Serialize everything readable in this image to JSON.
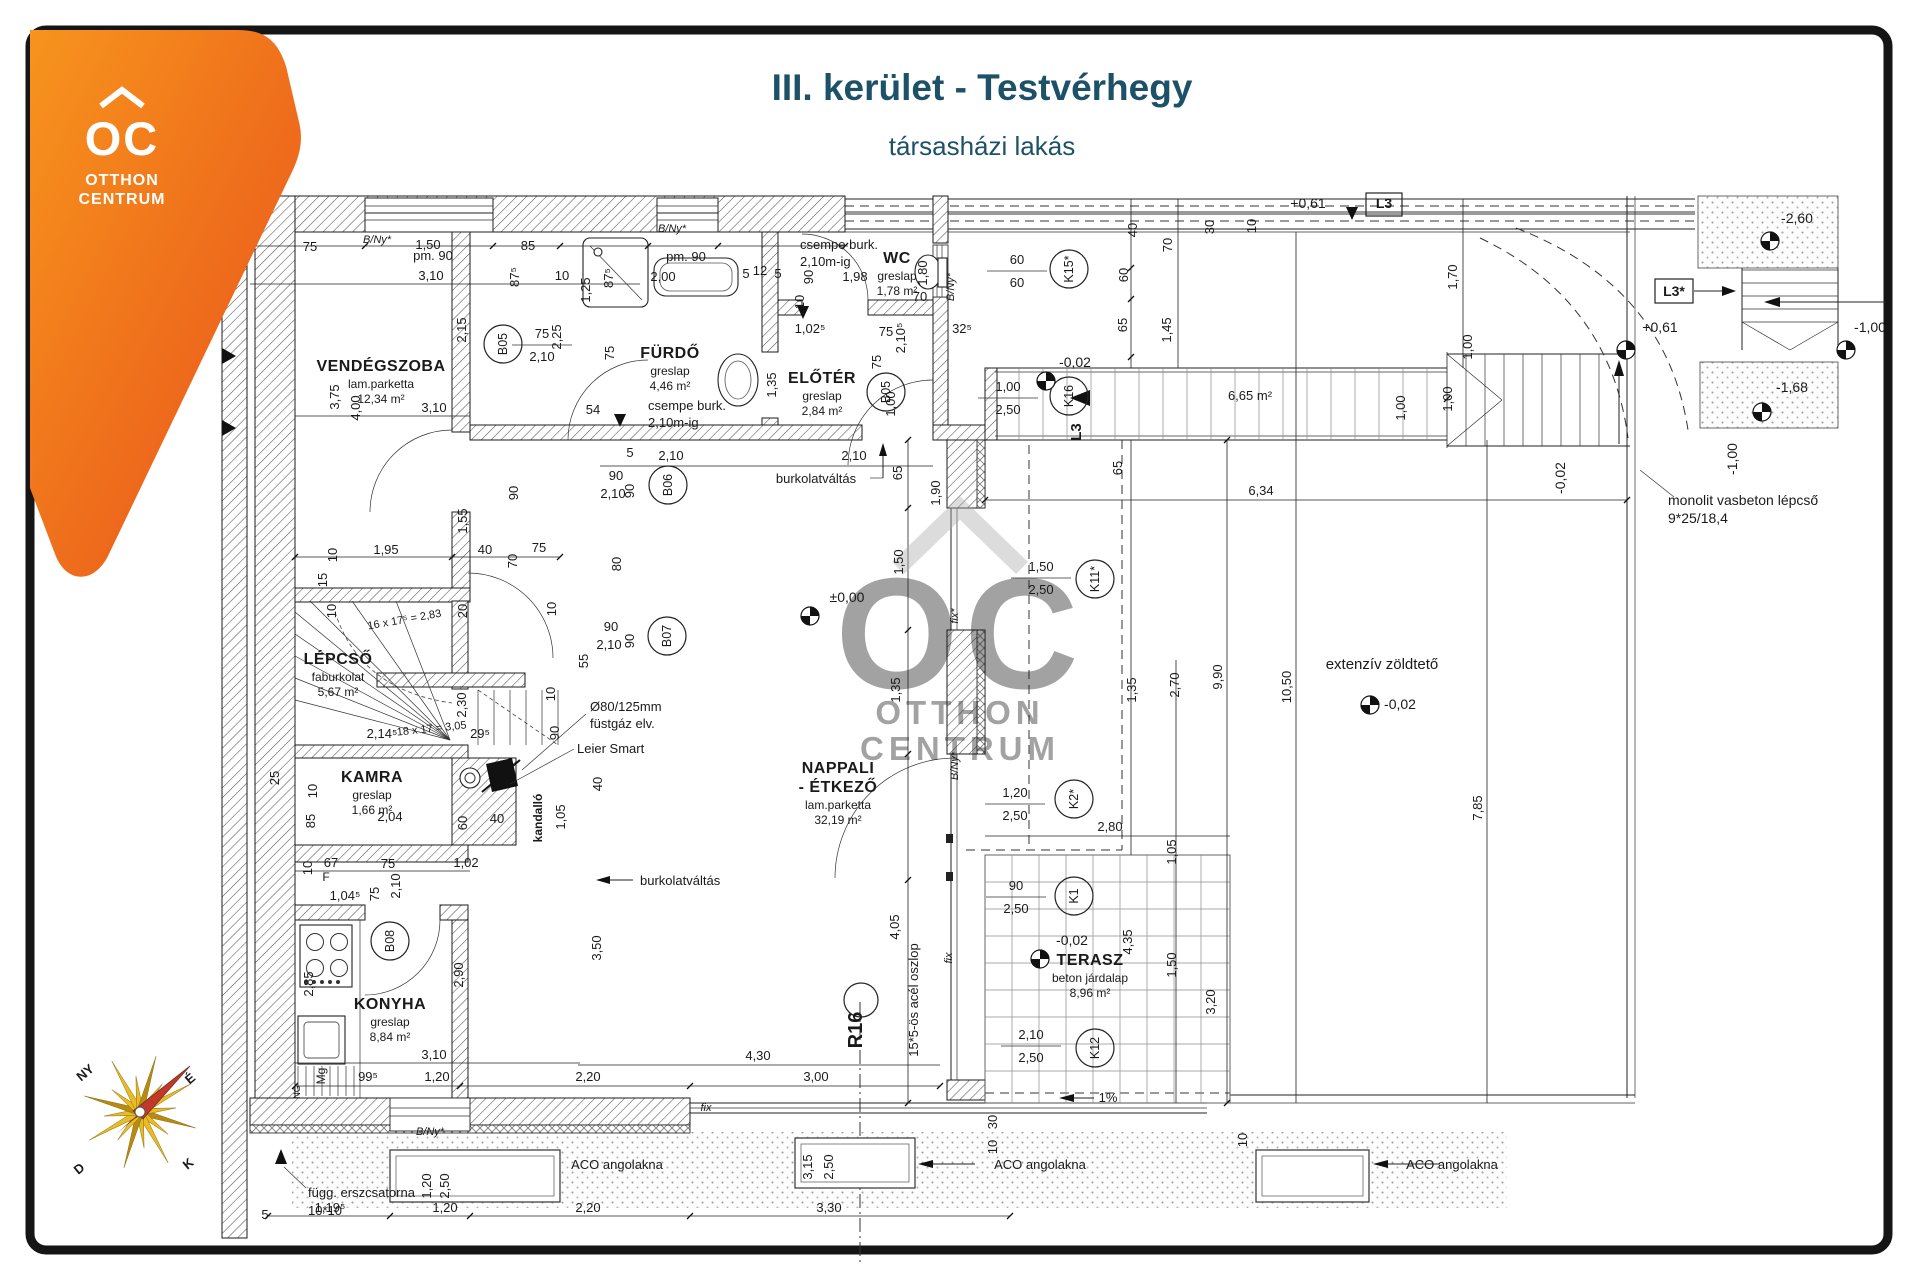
{
  "header": {
    "title": "III. kerület - Testvérhegy",
    "subtitle": "társasházi lakás",
    "color": "#1d5168"
  },
  "logo": {
    "brand": "OC",
    "line1": "OTTHON",
    "line2": "CENTRUM",
    "color_top": "#f7941d",
    "color_bottom": "#e84e1b"
  },
  "watermark": {
    "oc": "OC",
    "line1": "OTTHON",
    "line2": "CENTRUM"
  },
  "compass": {
    "labels": [
      {
        "t": "NY",
        "x": 88,
        "y": 1076,
        "r": -40
      },
      {
        "t": "É",
        "x": 193,
        "y": 1082,
        "r": -40
      },
      {
        "t": "D",
        "x": 82,
        "y": 1172,
        "r": -40
      },
      {
        "t": "K",
        "x": 191,
        "y": 1167,
        "r": -40
      }
    ]
  },
  "rooms": [
    {
      "name": "VENDÉGSZOBA",
      "name2": "",
      "floor": "lam.parketta",
      "area": "12,34 m²",
      "x": 381,
      "y": 371
    },
    {
      "name": "FÜRDŐ",
      "name2": "",
      "floor": "greslap",
      "area": "4,46 m²",
      "x": 670,
      "y": 358
    },
    {
      "name": "WC",
      "name2": "",
      "floor": "greslap",
      "area": "1,78 m²",
      "x": 897,
      "y": 263
    },
    {
      "name": "ELŐTÉR",
      "name2": "",
      "floor": "greslap",
      "area": "2,84 m²",
      "x": 822,
      "y": 383
    },
    {
      "name": "LÉPCSŐ",
      "name2": "",
      "floor": "faburkolat",
      "area": "5,67 m²",
      "x": 338,
      "y": 664
    },
    {
      "name": "KAMRA",
      "name2": "",
      "floor": "greslap",
      "area": "1,66 m²",
      "x": 372,
      "y": 782
    },
    {
      "name": "KONYHA",
      "name2": "",
      "floor": "greslap",
      "area": "8,84 m²",
      "x": 390,
      "y": 1009
    },
    {
      "name": "NAPPALI",
      "name2": "- ÉTKEZŐ",
      "floor": "lam.parketta",
      "area": "32,19 m²",
      "x": 838,
      "y": 773
    },
    {
      "name": "TERASZ",
      "name2": "",
      "floor": "beton járdalap",
      "area": "8,96 m²",
      "x": 1090,
      "y": 965
    }
  ],
  "annotations": [
    {
      "t": "burkolatváltás",
      "x": 816,
      "y": 483
    },
    {
      "t": "burkolatváltás",
      "x": 640,
      "y": 885,
      "anchor": "start"
    },
    {
      "t": "csempe burk.",
      "x": 648,
      "y": 410,
      "anchor": "start"
    },
    {
      "t": "2,10m-ig",
      "x": 648,
      "y": 427,
      "anchor": "start"
    },
    {
      "t": "csempe burk.",
      "x": 800,
      "y": 249,
      "anchor": "start"
    },
    {
      "t": "2,10m-ig",
      "x": 800,
      "y": 266,
      "anchor": "start"
    },
    {
      "t": "extenzív zöldtető",
      "x": 1382,
      "y": 669,
      "fs": 15
    },
    {
      "t": "monolit vasbeton lépcső",
      "x": 1668,
      "y": 505,
      "anchor": "start",
      "fs": 14
    },
    {
      "t": "9*25/18,4",
      "x": 1668,
      "y": 523,
      "anchor": "start",
      "fs": 14
    },
    {
      "t": "ACO angolakna",
      "x": 617,
      "y": 1169
    },
    {
      "t": "ACO angolakna",
      "x": 1040,
      "y": 1169
    },
    {
      "t": "ACO angolakna",
      "x": 1452,
      "y": 1169
    },
    {
      "t": "függ. erszcsatorna",
      "x": 308,
      "y": 1197,
      "anchor": "start"
    },
    {
      "t": "10*10",
      "x": 308,
      "y": 1215,
      "anchor": "start"
    },
    {
      "t": "Ø80/125mm",
      "x": 590,
      "y": 711,
      "anchor": "start"
    },
    {
      "t": "füstgáz elv.",
      "x": 590,
      "y": 728,
      "anchor": "start"
    },
    {
      "t": "Leier Smart",
      "x": 577,
      "y": 753,
      "anchor": "start"
    },
    {
      "t": "kandalló",
      "x": 542,
      "y": 818,
      "r": -90,
      "bold": true,
      "fs": 12
    },
    {
      "t": "15*5-ös acél oszlop",
      "x": 918,
      "y": 1000,
      "r": -90,
      "fs": 13
    },
    {
      "t": "R16",
      "x": 862,
      "y": 1030,
      "r": -90,
      "fs": 20,
      "bold": true
    },
    {
      "t": "16 x 17⁵ = 2,83",
      "x": 405,
      "y": 623,
      "r": -10,
      "fs": 11
    },
    {
      "t": "18 x 17 = 3,05",
      "x": 432,
      "y": 732,
      "r": -6,
      "fs": 11
    },
    {
      "t": "1%",
      "x": 1108,
      "y": 1102,
      "fs": 13
    },
    {
      "t": "fix",
      "x": 706,
      "y": 1111,
      "fs": 11,
      "style": "italic"
    },
    {
      "t": "fix",
      "x": 952,
      "y": 958,
      "r": -90,
      "fs": 11,
      "style": "italic"
    },
    {
      "t": "fix*",
      "x": 958,
      "y": 616,
      "r": -90,
      "fs": 11,
      "style": "italic"
    },
    {
      "t": "B/Ny*",
      "x": 958,
      "y": 766,
      "r": -90,
      "fs": 11,
      "style": "italic"
    },
    {
      "t": "B/Ny*",
      "x": 377,
      "y": 243,
      "fs": 11,
      "style": "italic"
    },
    {
      "t": "B/Ny*",
      "x": 954,
      "y": 287,
      "r": -90,
      "fs": 11,
      "style": "italic"
    },
    {
      "t": "B/Ny*",
      "x": 672,
      "y": 232,
      "fs": 11,
      "style": "italic"
    },
    {
      "t": "B/Ny*",
      "x": 430,
      "y": 1135,
      "fs": 11,
      "style": "italic"
    },
    {
      "t": "Mg",
      "x": 325,
      "y": 1076,
      "r": -90,
      "fs": 12
    },
    {
      "t": "F",
      "x": 326,
      "y": 881,
      "fs": 12
    },
    {
      "t": "NG",
      "x": 300,
      "y": 1092,
      "r": -90,
      "fs": 9
    },
    {
      "t": "pm. 90",
      "x": 433,
      "y": 260,
      "fs": 13
    },
    {
      "t": "pm. 90",
      "x": 686,
      "y": 261,
      "fs": 13
    },
    {
      "t": "L3",
      "x": 1384,
      "y": 208,
      "bold": true,
      "fs": 14
    },
    {
      "t": "L3*",
      "x": 1674,
      "y": 296,
      "bold": true,
      "fs": 14
    },
    {
      "t": "L3",
      "x": 1081,
      "y": 432,
      "r": -90,
      "bold": true,
      "fs": 15
    }
  ],
  "levels": [
    {
      "t": "±0,00",
      "x": 847,
      "y": 602,
      "sx": 810,
      "sy": 616
    },
    {
      "t": "-0,02",
      "x": 1075,
      "y": 367,
      "sx": 1046,
      "sy": 381
    },
    {
      "t": "-0,02",
      "x": 1072,
      "y": 945,
      "sx": 1040,
      "sy": 959
    },
    {
      "t": "-0,02",
      "x": 1400,
      "y": 709,
      "sx": 1370,
      "sy": 705
    },
    {
      "t": "-0,02",
      "x": 1565,
      "y": 478,
      "r": -90
    },
    {
      "t": "+0,61",
      "x": 1308,
      "y": 208
    },
    {
      "t": "+0,61",
      "x": 1660,
      "y": 332,
      "sx": 1626,
      "sy": 350
    },
    {
      "t": "-2,60",
      "x": 1797,
      "y": 223,
      "sx": 1770,
      "sy": 241
    },
    {
      "t": "-1,00",
      "x": 1870,
      "y": 332,
      "sx": 1846,
      "sy": 350
    },
    {
      "t": "-1,68",
      "x": 1792,
      "y": 392,
      "sx": 1762,
      "sy": 412
    },
    {
      "t": "-1,00",
      "x": 1737,
      "y": 459,
      "r": -90
    }
  ],
  "markers": [
    {
      "t": "B05",
      "x": 503,
      "y": 344
    },
    {
      "t": "B05",
      "x": 886,
      "y": 392
    },
    {
      "t": "B06",
      "x": 668,
      "y": 485
    },
    {
      "t": "B07",
      "x": 667,
      "y": 636
    },
    {
      "t": "B08",
      "x": 390,
      "y": 941
    },
    {
      "t": "K15*",
      "x": 1069,
      "y": 269
    },
    {
      "t": "K16",
      "x": 1069,
      "y": 396
    },
    {
      "t": "K11*",
      "x": 1095,
      "y": 579
    },
    {
      "t": "K2*",
      "x": 1074,
      "y": 799
    },
    {
      "t": "K1",
      "x": 1074,
      "y": 896
    },
    {
      "t": "K12",
      "x": 1095,
      "y": 1048
    }
  ],
  "window_dims": [
    {
      "a": "60",
      "b": "60",
      "x": 1017,
      "y": 271
    },
    {
      "a": "1,00",
      "b": "2,50",
      "x": 1008,
      "y": 398
    },
    {
      "a": "1,50",
      "b": "2,50",
      "x": 1041,
      "y": 578
    },
    {
      "a": "1,20",
      "b": "2,50",
      "x": 1015,
      "y": 804
    },
    {
      "a": "90",
      "b": "2,50",
      "x": 1016,
      "y": 897
    },
    {
      "a": "2,10",
      "b": "2,50",
      "x": 1031,
      "y": 1046
    },
    {
      "a": "75",
      "b": "2,10",
      "x": 542,
      "y": 345
    }
  ],
  "dims": [
    {
      "t": "75",
      "x": 310,
      "y": 251
    },
    {
      "t": "1,50",
      "x": 428,
      "y": 249
    },
    {
      "t": "85",
      "x": 528,
      "y": 250
    },
    {
      "t": "3,10",
      "x": 431,
      "y": 280
    },
    {
      "t": "87⁵",
      "x": 519,
      "y": 277,
      "r": -90
    },
    {
      "t": "10",
      "x": 562,
      "y": 280
    },
    {
      "t": "2,15",
      "x": 466,
      "y": 330,
      "r": -90
    },
    {
      "t": "3,75",
      "x": 339,
      "y": 397,
      "r": -90
    },
    {
      "t": "4,00",
      "x": 360,
      "y": 408,
      "r": -90
    },
    {
      "t": "3,10",
      "x": 434,
      "y": 412
    },
    {
      "t": "1,25",
      "x": 590,
      "y": 290,
      "r": -90
    },
    {
      "t": "87⁵",
      "x": 613,
      "y": 278,
      "r": -90
    },
    {
      "t": "75",
      "x": 614,
      "y": 353,
      "r": -90
    },
    {
      "t": "2,25",
      "x": 561,
      "y": 337,
      "r": -90
    },
    {
      "t": "54",
      "x": 593,
      "y": 414
    },
    {
      "t": "2,00",
      "x": 663,
      "y": 281
    },
    {
      "t": "5",
      "x": 746,
      "y": 278
    },
    {
      "t": "12",
      "x": 760,
      "y": 275
    },
    {
      "t": "5",
      "x": 778,
      "y": 278
    },
    {
      "t": "90",
      "x": 813,
      "y": 277,
      "r": -90
    },
    {
      "t": "10",
      "x": 804,
      "y": 302,
      "r": -90
    },
    {
      "t": "1,98",
      "x": 855,
      "y": 281
    },
    {
      "t": "1,80",
      "x": 927,
      "y": 273,
      "r": -90
    },
    {
      "t": "70",
      "x": 920,
      "y": 301
    },
    {
      "t": "1,02⁵",
      "x": 810,
      "y": 333
    },
    {
      "t": "75",
      "x": 886,
      "y": 336
    },
    {
      "t": "2,10⁵",
      "x": 905,
      "y": 338,
      "r": -90
    },
    {
      "t": "32⁵",
      "x": 962,
      "y": 333
    },
    {
      "t": "1,35",
      "x": 776,
      "y": 385,
      "r": -90
    },
    {
      "t": "75",
      "x": 881,
      "y": 362,
      "r": -90
    },
    {
      "t": "1,00",
      "x": 895,
      "y": 404,
      "r": -90
    },
    {
      "t": "5",
      "x": 630,
      "y": 457
    },
    {
      "t": "2,10",
      "x": 671,
      "y": 460
    },
    {
      "t": "2,10",
      "x": 854,
      "y": 460
    },
    {
      "t": "65",
      "x": 902,
      "y": 473,
      "r": -90
    },
    {
      "t": "90",
      "x": 616,
      "y": 480
    },
    {
      "t": "90",
      "x": 634,
      "y": 491,
      "r": -90
    },
    {
      "t": "2,10",
      "x": 613,
      "y": 498
    },
    {
      "t": "80",
      "x": 621,
      "y": 564,
      "r": -90
    },
    {
      "t": "10",
      "x": 556,
      "y": 609,
      "r": -90
    },
    {
      "t": "90",
      "x": 611,
      "y": 631
    },
    {
      "t": "90",
      "x": 634,
      "y": 641,
      "r": -90
    },
    {
      "t": "2,10",
      "x": 609,
      "y": 649
    },
    {
      "t": "55",
      "x": 588,
      "y": 661,
      "r": -90
    },
    {
      "t": "1,95",
      "x": 386,
      "y": 554
    },
    {
      "t": "40",
      "x": 485,
      "y": 554
    },
    {
      "t": "75",
      "x": 539,
      "y": 552
    },
    {
      "t": "70",
      "x": 517,
      "y": 561,
      "r": -90
    },
    {
      "t": "10",
      "x": 337,
      "y": 555,
      "r": -90
    },
    {
      "t": "90",
      "x": 518,
      "y": 493,
      "r": -90
    },
    {
      "t": "1,55",
      "x": 467,
      "y": 521,
      "r": -90
    },
    {
      "t": "15",
      "x": 327,
      "y": 580,
      "r": -90
    },
    {
      "t": "10",
      "x": 336,
      "y": 611,
      "r": -90
    },
    {
      "t": "20",
      "x": 467,
      "y": 611,
      "r": -90
    },
    {
      "t": "2,14⁵",
      "x": 382,
      "y": 738
    },
    {
      "t": "29⁵",
      "x": 480,
      "y": 738
    },
    {
      "t": "2,30",
      "x": 466,
      "y": 705,
      "r": -90
    },
    {
      "t": "25",
      "x": 279,
      "y": 778,
      "r": -90
    },
    {
      "t": "10",
      "x": 317,
      "y": 791,
      "r": -90
    },
    {
      "t": "85",
      "x": 315,
      "y": 821,
      "r": -90
    },
    {
      "t": "2,04",
      "x": 390,
      "y": 821
    },
    {
      "t": "60",
      "x": 467,
      "y": 823,
      "r": -90
    },
    {
      "t": "40",
      "x": 497,
      "y": 823
    },
    {
      "t": "1,05",
      "x": 565,
      "y": 817,
      "r": -90
    },
    {
      "t": "90",
      "x": 559,
      "y": 733,
      "r": -90
    },
    {
      "t": "10",
      "x": 555,
      "y": 694,
      "r": -90
    },
    {
      "t": "40",
      "x": 602,
      "y": 784,
      "r": -90
    },
    {
      "t": "10",
      "x": 312,
      "y": 868,
      "r": -90
    },
    {
      "t": "67",
      "x": 331,
      "y": 867
    },
    {
      "t": "75",
      "x": 388,
      "y": 868
    },
    {
      "t": "1,02",
      "x": 466,
      "y": 867
    },
    {
      "t": "1,04⁵",
      "x": 345,
      "y": 900
    },
    {
      "t": "75",
      "x": 379,
      "y": 894,
      "r": -90
    },
    {
      "t": "2,10",
      "x": 400,
      "y": 886,
      "r": -90
    },
    {
      "t": "2,85",
      "x": 313,
      "y": 984,
      "r": -90
    },
    {
      "t": "2,90",
      "x": 463,
      "y": 975,
      "r": -90
    },
    {
      "t": "3,50",
      "x": 601,
      "y": 948,
      "r": -90
    },
    {
      "t": "3,10",
      "x": 434,
      "y": 1059
    },
    {
      "t": "99⁵",
      "x": 368,
      "y": 1081
    },
    {
      "t": "1,20",
      "x": 437,
      "y": 1081
    },
    {
      "t": "2,20",
      "x": 588,
      "y": 1081
    },
    {
      "t": "4,30",
      "x": 758,
      "y": 1060
    },
    {
      "t": "3,00",
      "x": 816,
      "y": 1081
    },
    {
      "t": "1,19⁵",
      "x": 330,
      "y": 1212
    },
    {
      "t": "1,20",
      "x": 445,
      "y": 1212
    },
    {
      "t": "2,20",
      "x": 588,
      "y": 1212
    },
    {
      "t": "3,30",
      "x": 829,
      "y": 1212
    },
    {
      "t": "5",
      "x": 265,
      "y": 1219
    },
    {
      "t": "1,20",
      "x": 431,
      "y": 1186,
      "r": -90
    },
    {
      "t": "2,50",
      "x": 449,
      "y": 1186,
      "r": -90
    },
    {
      "t": "3,15",
      "x": 812,
      "y": 1167,
      "r": -90
    },
    {
      "t": "2,50",
      "x": 833,
      "y": 1167,
      "r": -90
    },
    {
      "t": "4,05",
      "x": 899,
      "y": 927,
      "r": -90
    },
    {
      "t": "40",
      "x": 1137,
      "y": 230,
      "r": -90
    },
    {
      "t": "70",
      "x": 1172,
      "y": 245,
      "r": -90
    },
    {
      "t": "30",
      "x": 1214,
      "y": 227,
      "r": -90
    },
    {
      "t": "10",
      "x": 1256,
      "y": 226,
      "r": -90
    },
    {
      "t": "60",
      "x": 1128,
      "y": 275,
      "r": -90
    },
    {
      "t": "65",
      "x": 1127,
      "y": 325,
      "r": -90
    },
    {
      "t": "1,45",
      "x": 1171,
      "y": 330,
      "r": -90
    },
    {
      "t": "1,70",
      "x": 1457,
      "y": 277,
      "r": -90
    },
    {
      "t": "1,90",
      "x": 940,
      "y": 493,
      "r": -90
    },
    {
      "t": "65",
      "x": 1122,
      "y": 468,
      "r": -90
    },
    {
      "t": "1,50",
      "x": 903,
      "y": 562,
      "r": -90
    },
    {
      "t": "1,35",
      "x": 900,
      "y": 690,
      "r": -90
    },
    {
      "t": "6,65 m²",
      "x": 1250,
      "y": 400
    },
    {
      "t": "1,00",
      "x": 1452,
      "y": 399,
      "r": -90
    },
    {
      "t": "1,00",
      "x": 1405,
      "y": 408,
      "r": -90
    },
    {
      "t": "6,34",
      "x": 1261,
      "y": 495
    },
    {
      "t": "1,00",
      "x": 1472,
      "y": 347,
      "r": -90
    },
    {
      "t": "1,35",
      "x": 1136,
      "y": 690,
      "r": -90
    },
    {
      "t": "2,70",
      "x": 1179,
      "y": 685,
      "r": -90
    },
    {
      "t": "9,90",
      "x": 1222,
      "y": 677,
      "r": -90
    },
    {
      "t": "10,50",
      "x": 1291,
      "y": 687,
      "r": -90
    },
    {
      "t": "7,85",
      "x": 1482,
      "y": 808,
      "r": -90
    },
    {
      "t": "2,80",
      "x": 1110,
      "y": 831
    },
    {
      "t": "1,05",
      "x": 1176,
      "y": 852,
      "r": -90
    },
    {
      "t": "4,35",
      "x": 1132,
      "y": 942,
      "r": -90
    },
    {
      "t": "1,50",
      "x": 1176,
      "y": 965,
      "r": -90
    },
    {
      "t": "3,20",
      "x": 1215,
      "y": 1002,
      "r": -90
    },
    {
      "t": "10",
      "x": 997,
      "y": 1147,
      "r": -90
    },
    {
      "t": "30",
      "x": 997,
      "y": 1122,
      "r": -90
    },
    {
      "t": "10",
      "x": 1247,
      "y": 1140,
      "r": -90
    }
  ]
}
